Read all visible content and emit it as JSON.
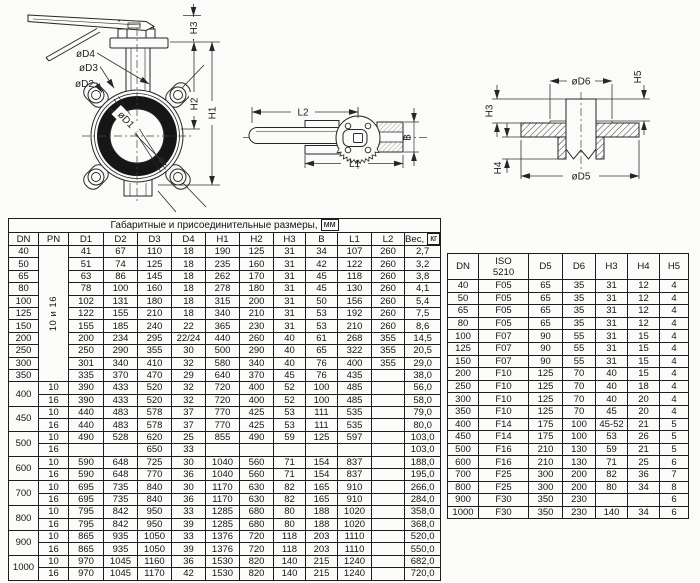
{
  "drawings": {
    "front_view": {
      "labels": {
        "d4": "øD4",
        "d3": "øD3",
        "d2": "øD2",
        "d1": "øD1",
        "h3": "H3",
        "h2": "H2",
        "h1": "H1"
      }
    },
    "top_view": {
      "labels": {
        "l2": "L2",
        "l1": "L1",
        "b": "B"
      }
    },
    "section_view": {
      "labels": {
        "d6": "øD6",
        "d5": "øD5",
        "h3": "H3",
        "h4": "H4",
        "h5": "H5"
      }
    }
  },
  "main_table": {
    "title": {
      "label": "Габаритные и присоединительные размеры,",
      "boxed": "мм"
    },
    "headers": [
      "DN",
      "PN",
      "D1",
      "D2",
      "D3",
      "D4",
      "H1",
      "H2",
      "H3",
      "B",
      "L1",
      "L2",
      {
        "label": "Вес,",
        "boxed": "кг"
      }
    ],
    "col_widths": [
      30,
      30,
      35,
      34,
      34,
      34,
      34,
      34,
      32,
      32,
      34,
      33,
      33
    ],
    "rows": [
      [
        {
          "v": "40"
        },
        {
          "v": "10 и 16",
          "rowspan": 11,
          "rot": true
        },
        "41",
        "67",
        "110",
        "18",
        "190",
        "125",
        "31",
        "34",
        "107",
        "260",
        "2,7"
      ],
      [
        "50",
        "51",
        "74",
        "125",
        "18",
        "235",
        "160",
        "31",
        "42",
        "122",
        "260",
        "3,2"
      ],
      [
        "65",
        "63",
        "86",
        "145",
        "18",
        "262",
        "170",
        "31",
        "45",
        "118",
        "260",
        "3,8"
      ],
      [
        "80",
        "78",
        "100",
        "160",
        "18",
        "278",
        "180",
        "31",
        "45",
        "130",
        "260",
        "4,1"
      ],
      [
        "100",
        "102",
        "131",
        "180",
        "18",
        "315",
        "200",
        "31",
        "50",
        "156",
        "260",
        "5,4"
      ],
      [
        "125",
        "122",
        "155",
        "210",
        "18",
        "340",
        "210",
        "31",
        "53",
        "192",
        "260",
        "7,5"
      ],
      [
        "150",
        "155",
        "185",
        "240",
        "22",
        "365",
        "230",
        "31",
        "53",
        "210",
        "260",
        "8,6"
      ],
      [
        "200",
        "200",
        "234",
        "295",
        "22/24",
        "440",
        "260",
        "40",
        "61",
        "268",
        "355",
        "14,5"
      ],
      [
        "250",
        "250",
        "290",
        "355",
        "30",
        "500",
        "290",
        "40",
        "65",
        "322",
        "355",
        "20,5"
      ],
      [
        "300",
        "301",
        "340",
        "410",
        "32",
        "580",
        "340",
        "40",
        "76",
        "400",
        "355",
        "29,0"
      ],
      [
        "350",
        "335",
        "370",
        "470",
        "29",
        "640",
        "370",
        "45",
        "76",
        "435",
        "",
        "38,0"
      ],
      [
        {
          "v": "400",
          "rowspan": 2
        },
        "10",
        "390",
        "433",
        "520",
        "32",
        "720",
        "400",
        "52",
        "100",
        "485",
        "",
        "56,0"
      ],
      [
        "16",
        "390",
        "433",
        "520",
        "32",
        "720",
        "400",
        "52",
        "100",
        "485",
        "",
        "58,0"
      ],
      [
        {
          "v": "450",
          "rowspan": 2
        },
        "10",
        "440",
        "483",
        "578",
        "37",
        "770",
        "425",
        "53",
        "111",
        "535",
        "",
        "79,0"
      ],
      [
        "16",
        "440",
        "483",
        "578",
        "37",
        "770",
        "425",
        "53",
        "111",
        "535",
        "",
        "80,0"
      ],
      [
        {
          "v": "500",
          "rowspan": 2
        },
        "10",
        "490",
        "528",
        "620",
        "25",
        "855",
        "490",
        "59",
        "125",
        "597",
        "",
        "103,0"
      ],
      [
        "16",
        "",
        "",
        "650",
        "33",
        "",
        "",
        "",
        "",
        "",
        "",
        "103,0"
      ],
      [
        {
          "v": "600",
          "rowspan": 2
        },
        "10",
        "590",
        "648",
        "725",
        "30",
        "1040",
        "560",
        "71",
        "154",
        "837",
        "",
        "188,0"
      ],
      [
        "16",
        "590",
        "648",
        "770",
        "36",
        "1040",
        "560",
        "71",
        "154",
        "837",
        "",
        "195,0"
      ],
      [
        {
          "v": "700",
          "rowspan": 2
        },
        "10",
        "695",
        "735",
        "840",
        "30",
        "1170",
        "630",
        "82",
        "165",
        "910",
        "",
        "266,0"
      ],
      [
        "16",
        "695",
        "735",
        "840",
        "36",
        "1170",
        "630",
        "82",
        "165",
        "910",
        "",
        "284,0"
      ],
      [
        {
          "v": "800",
          "rowspan": 2
        },
        "10",
        "795",
        "842",
        "950",
        "33",
        "1285",
        "680",
        "80",
        "188",
        "1020",
        "",
        "358,0"
      ],
      [
        "16",
        "795",
        "842",
        "950",
        "39",
        "1285",
        "680",
        "80",
        "188",
        "1020",
        "",
        "368,0"
      ],
      [
        {
          "v": "900",
          "rowspan": 2
        },
        "10",
        "865",
        "935",
        "1050",
        "33",
        "1376",
        "720",
        "118",
        "203",
        "1110",
        "",
        "520,0"
      ],
      [
        "16",
        "865",
        "935",
        "1050",
        "39",
        "1376",
        "720",
        "118",
        "203",
        "1110",
        "",
        "550,0"
      ],
      [
        {
          "v": "1000",
          "rowspan": 2
        },
        "10",
        "970",
        "1045",
        "1160",
        "36",
        "1530",
        "820",
        "140",
        "215",
        "1240",
        "",
        "682,0"
      ],
      [
        "16",
        "970",
        "1045",
        "1170",
        "42",
        "1530",
        "820",
        "140",
        "215",
        "1240",
        "",
        "720,0"
      ]
    ]
  },
  "iso_table": {
    "headers": [
      "DN",
      {
        "lines": [
          "ISO",
          "5210"
        ]
      },
      "D5",
      "D6",
      "H3",
      "H4",
      "H5"
    ],
    "col_widths": [
      31,
      50,
      34,
      33,
      32,
      32,
      29
    ],
    "rows": [
      [
        "40",
        "F05",
        "65",
        "35",
        "31",
        "12",
        "4"
      ],
      [
        "50",
        "F05",
        "65",
        "35",
        "31",
        "12",
        "4"
      ],
      [
        "65",
        "F05",
        "65",
        "35",
        "31",
        "12",
        "4"
      ],
      [
        "80",
        "F05",
        "65",
        "35",
        "31",
        "12",
        "4"
      ],
      [
        "100",
        "F07",
        "90",
        "55",
        "31",
        "15",
        "4"
      ],
      [
        "125",
        "F07",
        "90",
        "55",
        "31",
        "15",
        "4"
      ],
      [
        "150",
        "F07",
        "90",
        "55",
        "31",
        "15",
        "4"
      ],
      [
        "200",
        "F10",
        "125",
        "70",
        "40",
        "15",
        "4"
      ],
      [
        "250",
        "F10",
        "125",
        "70",
        "40",
        "18",
        "4"
      ],
      [
        "300",
        "F10",
        "125",
        "70",
        "40",
        "20",
        "4"
      ],
      [
        "350",
        "F10",
        "125",
        "70",
        "45",
        "20",
        "4"
      ],
      [
        "400",
        "F14",
        "175",
        "100",
        "45-52",
        "21",
        "5"
      ],
      [
        "450",
        "F14",
        "175",
        "100",
        "53",
        "26",
        "5"
      ],
      [
        "500",
        "F16",
        "210",
        "130",
        "59",
        "21",
        "5"
      ],
      [
        "600",
        "F16",
        "210",
        "130",
        "71",
        "25",
        "6"
      ],
      [
        "700",
        "F25",
        "300",
        "200",
        "82",
        "36",
        "7"
      ],
      [
        "800",
        "F25",
        "300",
        "200",
        "80",
        "34",
        "8"
      ],
      [
        "900",
        "F30",
        "350",
        "230",
        "",
        "",
        "6"
      ],
      [
        "1000",
        "F30",
        "350",
        "230",
        "140",
        "34",
        "6"
      ]
    ]
  },
  "colors": {
    "line": "#262626",
    "dark_ring": "#161616",
    "bg": "#fbfbf9"
  }
}
